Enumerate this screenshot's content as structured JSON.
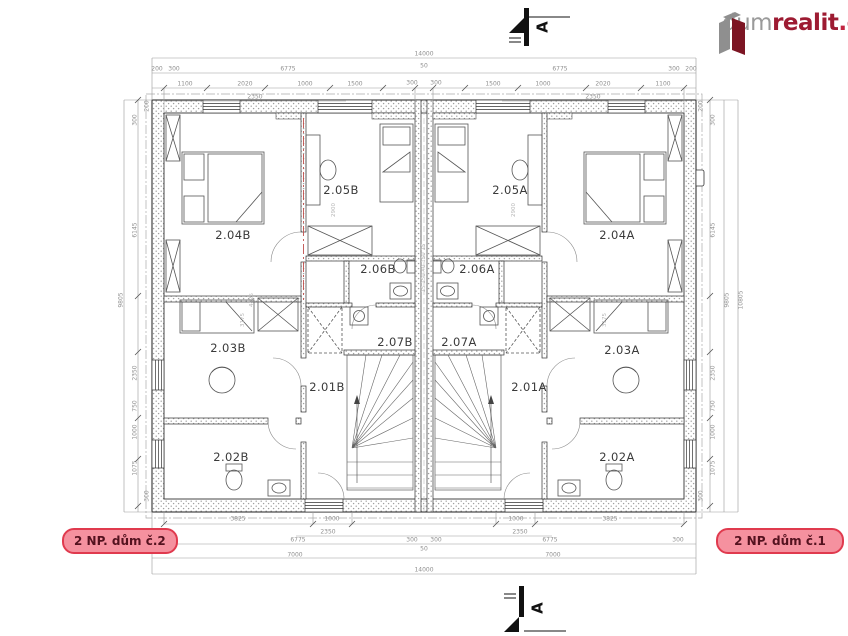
{
  "logo": {
    "gray": "dum",
    "red": "realit",
    "suffix": ".cz"
  },
  "section_markers": {
    "top_letter": "A",
    "bottom_letter": "A"
  },
  "unit_labels": {
    "left": "2 NP. dům č.2",
    "right": "2 NP. dům č.1"
  },
  "colors": {
    "accent_red": "#e03a4e",
    "label_bg": "#f5919f",
    "logo_gray": "#8f8f8f",
    "logo_red": "#9d1b32"
  },
  "floorplan": {
    "rooms": [
      {
        "label": "2.04B",
        "x": 233,
        "y": 235
      },
      {
        "label": "2.05B",
        "x": 341,
        "y": 190
      },
      {
        "label": "2.06B",
        "x": 378,
        "y": 269
      },
      {
        "label": "2.07B",
        "x": 395,
        "y": 342
      },
      {
        "label": "2.01B",
        "x": 327,
        "y": 387
      },
      {
        "label": "2.03B",
        "x": 228,
        "y": 348
      },
      {
        "label": "2.02B",
        "x": 231,
        "y": 457
      },
      {
        "label": "2.05A",
        "x": 510,
        "y": 190
      },
      {
        "label": "2.06A",
        "x": 477,
        "y": 269
      },
      {
        "label": "2.07A",
        "x": 459,
        "y": 342
      },
      {
        "label": "2.01A",
        "x": 529,
        "y": 387
      },
      {
        "label": "2.04A",
        "x": 617,
        "y": 235
      },
      {
        "label": "2.03A",
        "x": 622,
        "y": 350
      },
      {
        "label": "2.02A",
        "x": 617,
        "y": 457
      }
    ],
    "dimensions": [
      {
        "t": "14000",
        "x": 424,
        "y": 54
      },
      {
        "t": "6775",
        "x": 288,
        "y": 69
      },
      {
        "t": "6775",
        "x": 560,
        "y": 69
      },
      {
        "t": "200",
        "x": 157,
        "y": 69
      },
      {
        "t": "300",
        "x": 174,
        "y": 69
      },
      {
        "t": "300",
        "x": 674,
        "y": 69
      },
      {
        "t": "200",
        "x": 691,
        "y": 69
      },
      {
        "t": "50",
        "x": 424,
        "y": 66
      },
      {
        "t": "300",
        "x": 412,
        "y": 83
      },
      {
        "t": "300",
        "x": 436,
        "y": 83
      },
      {
        "t": "1100",
        "x": 185,
        "y": 84
      },
      {
        "t": "2020",
        "x": 245,
        "y": 84
      },
      {
        "t": "1000",
        "x": 305,
        "y": 84
      },
      {
        "t": "1500",
        "x": 355,
        "y": 84
      },
      {
        "t": "1500",
        "x": 493,
        "y": 84
      },
      {
        "t": "1000",
        "x": 543,
        "y": 84
      },
      {
        "t": "2020",
        "x": 603,
        "y": 84
      },
      {
        "t": "1100",
        "x": 663,
        "y": 84
      },
      {
        "t": "2350",
        "x": 255,
        "y": 97
      },
      {
        "t": "2350",
        "x": 593,
        "y": 97
      },
      {
        "t": "200",
        "x": 147,
        "y": 106,
        "r": -90
      },
      {
        "t": "300",
        "x": 135,
        "y": 120,
        "r": -90
      },
      {
        "t": "6145",
        "x": 135,
        "y": 230,
        "r": -90
      },
      {
        "t": "9805",
        "x": 121,
        "y": 300,
        "r": -90
      },
      {
        "t": "2350",
        "x": 135,
        "y": 373,
        "r": -90
      },
      {
        "t": "750",
        "x": 135,
        "y": 406,
        "r": -90
      },
      {
        "t": "1000",
        "x": 135,
        "y": 432,
        "r": -90
      },
      {
        "t": "1075",
        "x": 135,
        "y": 468,
        "r": -90
      },
      {
        "t": "300",
        "x": 147,
        "y": 496,
        "r": -90
      },
      {
        "t": "200",
        "x": 701,
        "y": 106,
        "r": -90
      },
      {
        "t": "300",
        "x": 713,
        "y": 120,
        "r": -90
      },
      {
        "t": "6145",
        "x": 713,
        "y": 230,
        "r": -90
      },
      {
        "t": "9805",
        "x": 727,
        "y": 300,
        "r": -90
      },
      {
        "t": "10805",
        "x": 741,
        "y": 300,
        "r": -90
      },
      {
        "t": "2350",
        "x": 713,
        "y": 373,
        "r": -90
      },
      {
        "t": "750",
        "x": 713,
        "y": 406,
        "r": -90
      },
      {
        "t": "1000",
        "x": 713,
        "y": 432,
        "r": -90
      },
      {
        "t": "1075",
        "x": 713,
        "y": 468,
        "r": -90
      },
      {
        "t": "300",
        "x": 701,
        "y": 496,
        "r": -90
      },
      {
        "t": "3825",
        "x": 238,
        "y": 519
      },
      {
        "t": "1000",
        "x": 332,
        "y": 519
      },
      {
        "t": "1000",
        "x": 516,
        "y": 519
      },
      {
        "t": "3825",
        "x": 610,
        "y": 519
      },
      {
        "t": "2350",
        "x": 328,
        "y": 532
      },
      {
        "t": "2350",
        "x": 520,
        "y": 532
      },
      {
        "t": "300",
        "x": 170,
        "y": 540
      },
      {
        "t": "6775",
        "x": 298,
        "y": 540
      },
      {
        "t": "300",
        "x": 412,
        "y": 540
      },
      {
        "t": "300",
        "x": 436,
        "y": 540
      },
      {
        "t": "6775",
        "x": 550,
        "y": 540
      },
      {
        "t": "300",
        "x": 678,
        "y": 540
      },
      {
        "t": "50",
        "x": 424,
        "y": 549
      },
      {
        "t": "7000",
        "x": 295,
        "y": 555
      },
      {
        "t": "7000",
        "x": 553,
        "y": 555
      },
      {
        "t": "14000",
        "x": 424,
        "y": 570
      },
      {
        "t": "4425",
        "x": 252,
        "y": 300,
        "r": -90,
        "f": 1
      },
      {
        "t": "3175",
        "x": 243,
        "y": 320,
        "r": -90,
        "f": 1
      },
      {
        "t": "2900",
        "x": 334,
        "y": 210,
        "r": -90,
        "f": 1
      },
      {
        "t": "2900",
        "x": 514,
        "y": 210,
        "r": -90,
        "f": 1
      },
      {
        "t": "3175",
        "x": 605,
        "y": 320,
        "r": -90,
        "f": 1
      },
      {
        "t": "15 150 40 150 15",
        "x": 424,
        "y": 268,
        "r": -90,
        "f": 1
      }
    ]
  }
}
